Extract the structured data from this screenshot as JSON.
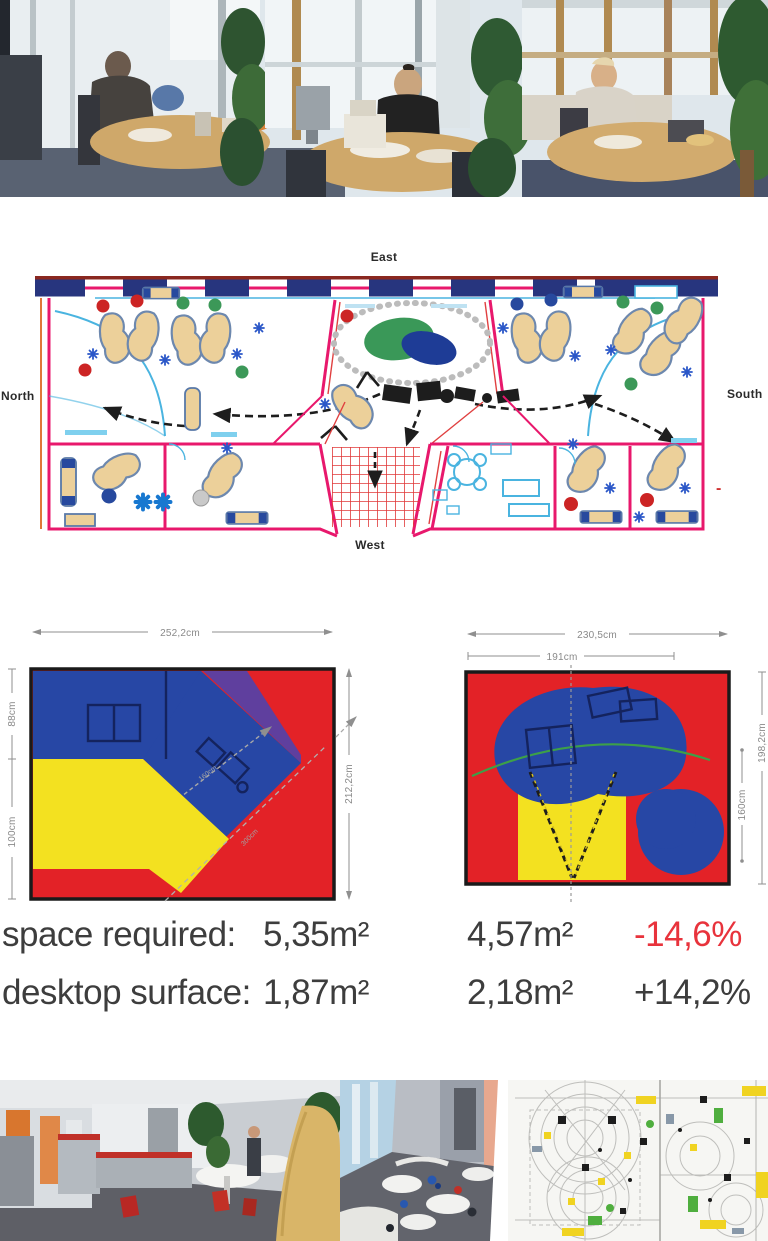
{
  "fp": {
    "east": "East",
    "north": "North",
    "south": "South",
    "west": "West",
    "dash": "-"
  },
  "dims": {
    "left": {
      "width": "252,2cm",
      "height": "212,2cm",
      "side_top": "88cm",
      "side_bottom": "100cm",
      "inner": "160cm",
      "diagonal": "300cm"
    },
    "right": {
      "width_outer": "230,5cm",
      "width_inner": "191cm",
      "height_outer": "198,2cm",
      "height_inner": "160cm"
    }
  },
  "stats": {
    "rows": [
      {
        "label": "space required:",
        "before": "5,35m²",
        "after": "4,57m²",
        "delta": "-14,6%"
      },
      {
        "label": "desktop surface:",
        "before": "1,87m²",
        "after": "2,18m²",
        "delta": "+14,2%"
      }
    ]
  },
  "colors": {
    "accent_red": "#e8333c",
    "text_dark": "#3d3d3d",
    "plan_magenta": "#e8186c",
    "diagram_blue": "#2747a5",
    "diagram_red": "#e32227",
    "diagram_yellow": "#f3e120",
    "diagram_purple": "#5f3f9e",
    "plan_cyan": "#4ab4e0",
    "desk_tan": "#ecd09a"
  }
}
